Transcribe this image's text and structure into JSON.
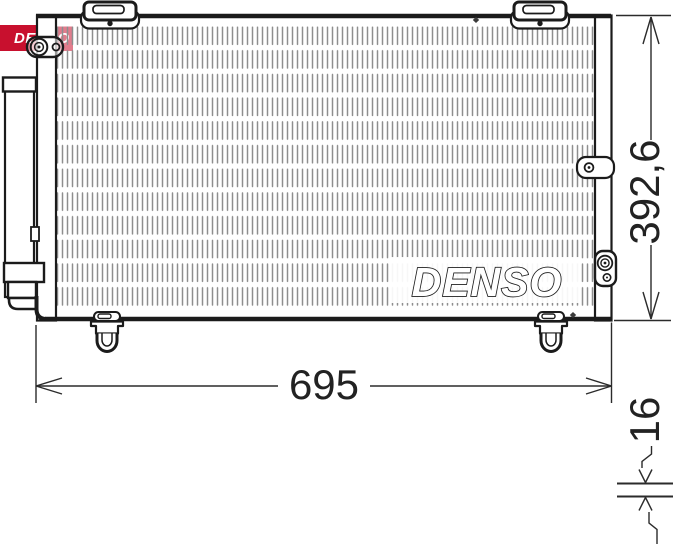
{
  "brand_logo": {
    "text": "DENSO",
    "background_color": "#c8102e",
    "text_color": "#ffffff"
  },
  "watermark_text": "DENSO",
  "dimensions": {
    "width_label": "695",
    "height_label": "392,6",
    "depth_label": "16"
  },
  "colors": {
    "denso_red": "#c8102e",
    "drawing_line": "#1b1b1b",
    "dimension_line": "#2b2b2b",
    "fin_gray": "#8e8e8e"
  }
}
